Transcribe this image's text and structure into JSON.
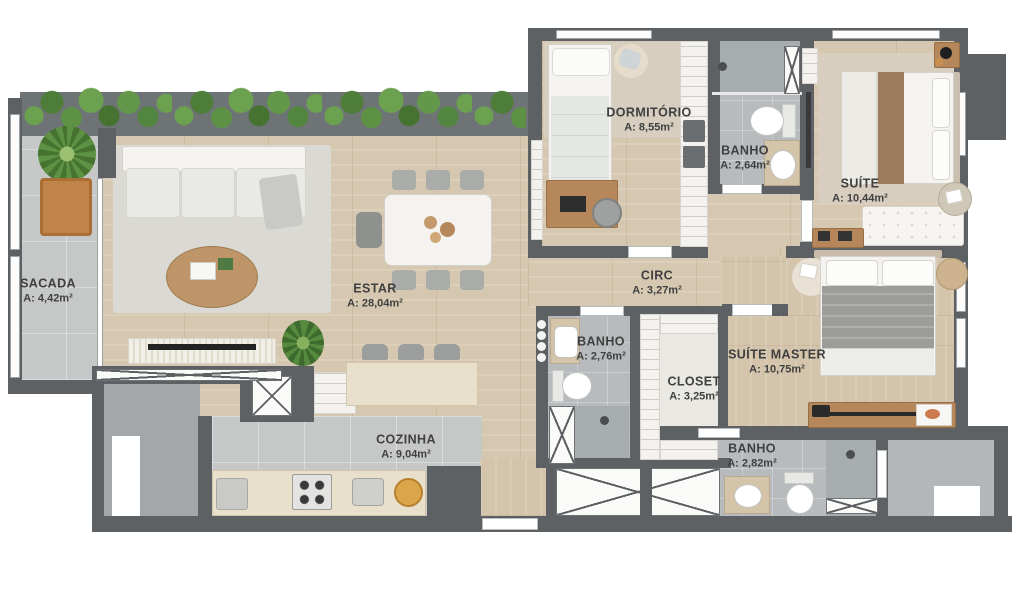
{
  "plan": {
    "type": "apartment-floor-plan",
    "rooms": [
      {
        "id": "sacada",
        "name": "SACADA",
        "area": "A: 4,42m²"
      },
      {
        "id": "estar",
        "name": "ESTAR",
        "area": "A: 28,04m²"
      },
      {
        "id": "dormitorio",
        "name": "DORMITÓRIO",
        "area": "A: 8,55m²"
      },
      {
        "id": "banho-1",
        "name": "BANHO",
        "area": "A: 2,64m²"
      },
      {
        "id": "suite",
        "name": "SUÍTE",
        "area": "A: 10,44m²"
      },
      {
        "id": "circ",
        "name": "CIRC",
        "area": "A: 3,27m²"
      },
      {
        "id": "banho-2",
        "name": "BANHO",
        "area": "A: 2,76m²"
      },
      {
        "id": "closet",
        "name": "CLOSET",
        "area": "A: 3,25m²"
      },
      {
        "id": "suite-master",
        "name": "SUÍTE MASTER",
        "area": "A: 10,75m²"
      },
      {
        "id": "banho-3",
        "name": "BANHO",
        "area": "A: 2,82m²"
      },
      {
        "id": "cozinha",
        "name": "COZINHA",
        "area": "A: 9,04m²"
      }
    ],
    "colors": {
      "wall": "#5d6164",
      "wood_floor": "#d6c8b0",
      "tile_floor": "#c6c8c8",
      "bath_tile": "#b7bbbd",
      "rug_beige": "#d8cec0",
      "counter_stone": "#e9e0cc",
      "foliage_green": "#5d9245",
      "accent_orange": "#c08448",
      "label_text": "#3f3f3f"
    }
  }
}
